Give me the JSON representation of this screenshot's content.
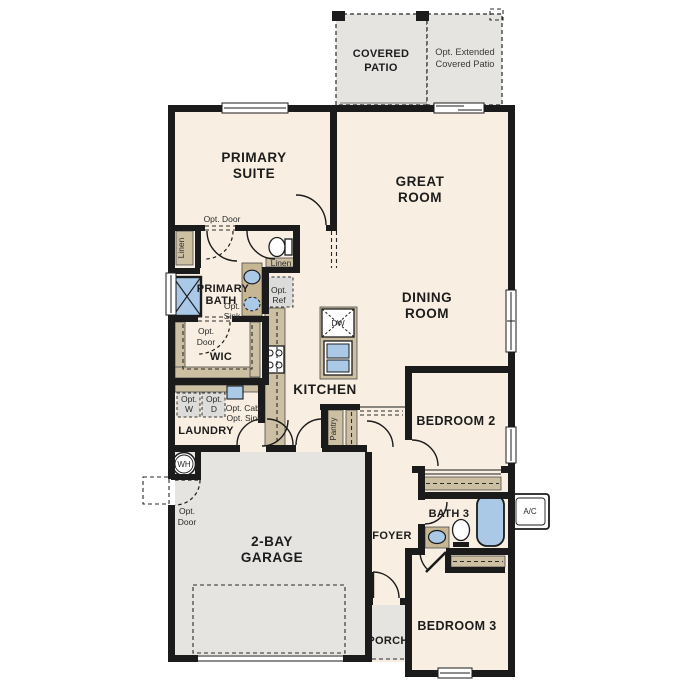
{
  "fp": {
    "rooms": {
      "covered_patio": {
        "l1": "COVERED",
        "l2": "PATIO"
      },
      "opt_patio": {
        "l1": "Opt. Extended",
        "l2": "Covered Patio"
      },
      "primary_suite": {
        "l1": "PRIMARY",
        "l2": "SUITE"
      },
      "great_room": {
        "l1": "GREAT",
        "l2": "ROOM"
      },
      "dining_room": {
        "l1": "DINING",
        "l2": "ROOM"
      },
      "primary_bath": {
        "l1": "PRIMARY",
        "l2": "BATH"
      },
      "wic": "WIC",
      "kitchen": "KITCHEN",
      "laundry": "LAUNDRY",
      "bedroom2": "BEDROOM 2",
      "garage": {
        "l1": "2-BAY",
        "l2": "GARAGE"
      },
      "foyer": "FOYER",
      "bath3": "BATH 3",
      "porch": "PORCH",
      "bedroom3": "BEDROOM 3"
    },
    "ann": {
      "opt_door": "Opt. Door",
      "opt": "Opt.",
      "door": "Door",
      "linen": "Linen",
      "sink": "Sink",
      "ref": "Ref",
      "w": "W",
      "d": "D",
      "opt_cab": "Opt. Cab/",
      "opt_sink": "Opt. Sink",
      "pantry": "Pantry",
      "dw": "DW",
      "wh": "WH",
      "ac": "A/C"
    },
    "colors": {
      "wall": "#1b1b1b",
      "interior": "#f8efe2",
      "concrete": "#e5e4e1",
      "casework": "#cdbfa2",
      "fixture_blue": "#a9c9e7",
      "optional_fill": "#dcdcda"
    }
  }
}
